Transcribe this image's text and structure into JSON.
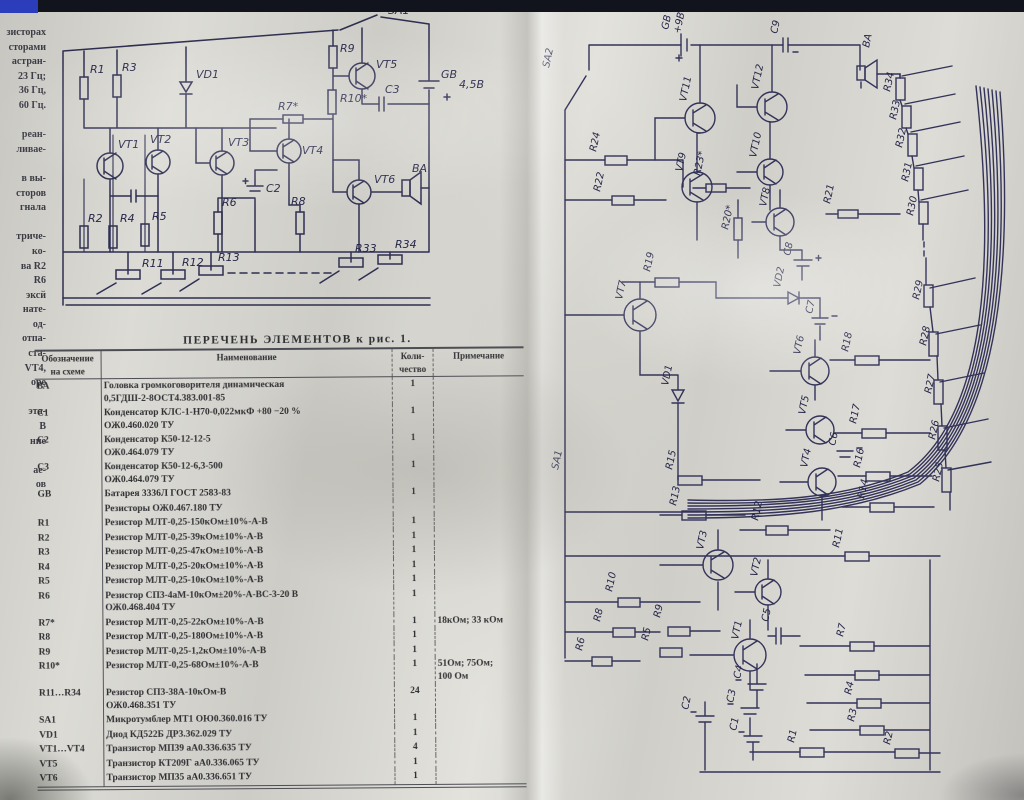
{
  "left_margin": {
    "lines": [
      "зисторах",
      "сторами",
      "астран-",
      "23 Гц;",
      "36 Гц,",
      "60 Гц.",
      "",
      "реан-",
      "ливае-",
      "",
      "в вы-",
      "сторов",
      "гнала",
      "",
      "триче-",
      "ко-",
      "ва R2",
      "R6",
      "эксй",
      "нате-",
      "од-",
      "отпа-",
      "ста-",
      "VT4,",
      "оре",
      "",
      "эта-",
      "В",
      "ние",
      "",
      "ае-",
      "ов"
    ]
  },
  "table": {
    "title": "ПЕРЕЧЕНЬ ЭЛЕМЕНТОВ к рис. 1.",
    "headers": {
      "designator": "Обозначение на схеме",
      "name": "Наименование",
      "qty": "Коли- чество",
      "note": "Примечание"
    },
    "rows": [
      {
        "d": "ВА",
        "n": [
          "Головка громкоговорителя динамическая",
          "0,5ГДШ-2-8ОСТ4.383.001-85"
        ],
        "q": "1",
        "note": []
      },
      {
        "d": "C1",
        "n": [
          "Конденсатор КЛС-1-Н70-0,022мкФ  +80 −20 %",
          "ОЖ0.460.020 ТУ"
        ],
        "q": "1",
        "note": []
      },
      {
        "d": "C2",
        "n": [
          "Конденсатор К50-12-12-5",
          "ОЖ0.464.079 ТУ"
        ],
        "q": "1",
        "note": []
      },
      {
        "d": "C3",
        "n": [
          "Конденсатор К50-12-6,3-500",
          "ОЖ0.464.079 ТУ"
        ],
        "q": "1",
        "note": []
      },
      {
        "d": "GB",
        "n": [
          "Батарея 3336Л ГОСТ 2583-83"
        ],
        "q": "1",
        "note": []
      },
      {
        "d": "",
        "n": [
          "Резисторы ОЖ0.467.180 ТУ"
        ],
        "q": "",
        "note": []
      },
      {
        "d": "R1",
        "n": [
          "Резистор МЛТ-0,25-150кОм±10%-А-В"
        ],
        "q": "1",
        "note": []
      },
      {
        "d": "R2",
        "n": [
          "Резистор МЛТ-0,25-39кОм±10%-А-В"
        ],
        "q": "1",
        "note": []
      },
      {
        "d": "R3",
        "n": [
          "Резистор МЛТ-0,25-47кОм±10%-А-В"
        ],
        "q": "1",
        "note": []
      },
      {
        "d": "R4",
        "n": [
          "Резистор МЛТ-0,25-20кОм±10%-А-В"
        ],
        "q": "1",
        "note": []
      },
      {
        "d": "R5",
        "n": [
          "Резистор МЛТ-0,25-10кОм±10%-А-В"
        ],
        "q": "1",
        "note": []
      },
      {
        "d": "R6",
        "n": [
          "Резистор СП3-4аМ-10кОм±20%-А-ВС-3-20 В",
          "ОЖ0.468.404 ТУ"
        ],
        "q": "1",
        "note": []
      },
      {
        "d": "R7*",
        "n": [
          "Резистор МЛТ-0,25-22кОм±10%-А-В"
        ],
        "q": "1",
        "note": [
          "18кОм; 33 кОм"
        ]
      },
      {
        "d": "R8",
        "n": [
          "Резистор МЛТ-0,25-180Ом±10%-А-В"
        ],
        "q": "1",
        "note": []
      },
      {
        "d": "R9",
        "n": [
          "Резистор МЛТ-0,25-1,2кОм±10%-А-В"
        ],
        "q": "1",
        "note": []
      },
      {
        "d": "R10*",
        "n": [
          "Резистор МЛТ-0,25-68Ом±10%-А-В"
        ],
        "q": "1",
        "note": [
          "51Ом; 75Ом;",
          "100 Ом"
        ]
      },
      {
        "d": "R11…R34",
        "n": [
          "Резистор СП3-38А-10кОм-В",
          "ОЖ0.468.351 ТУ"
        ],
        "q": "24",
        "note": []
      },
      {
        "d": "SA1",
        "n": [
          "Микротумблер МТ1 ОЮ0.360.016 ТУ"
        ],
        "q": "1",
        "note": []
      },
      {
        "d": "VD1",
        "n": [
          "Диод КД522Б ДР3.362.029 ТУ"
        ],
        "q": "1",
        "note": []
      },
      {
        "d": "VT1…VT4",
        "n": [
          "Транзистор МП39 аА0.336.635 ТУ"
        ],
        "q": "4",
        "note": []
      },
      {
        "d": "VT5",
        "n": [
          "Транзистор КТ209Г аА0.336.065 ТУ"
        ],
        "q": "1",
        "note": []
      },
      {
        "d": "VT6",
        "n": [
          "Транзистор МП35 аА0.336.651 ТУ"
        ],
        "q": "1",
        "note": []
      }
    ]
  },
  "fig1": {
    "labels": {
      "sa1": "SA1",
      "gb": "GB",
      "gb_v": "4,5В",
      "ba": "ВА",
      "vd1": "VD1",
      "vt1": "VT1",
      "vt2": "VT2",
      "vt3": "VT3",
      "vt4": "VT4",
      "vt5": "VT5",
      "vt6": "VT6",
      "r1": "R1",
      "r2": "R2",
      "r3": "R3",
      "r4": "R4",
      "r5": "R5",
      "r6": "R6",
      "r7": "R7*",
      "r8": "R8",
      "r9": "R9",
      "r10": "R10*",
      "r11": "R11",
      "r12": "R12",
      "r13": "R13",
      "r33": "R33",
      "r34": "R34",
      "c2": "C2",
      "c3": "C3"
    }
  },
  "fig2": {
    "labels": {
      "sa1": "SA1",
      "sa2": "SA2",
      "gb": "GB",
      "gb_v": "+9В",
      "c9": "C9",
      "ba": "ВА",
      "vt1": "VT1",
      "vt2": "VT2",
      "vt3": "VT3",
      "vt4": "VT4",
      "vt5": "VT5",
      "vt6": "VT6",
      "vt7": "VT7",
      "vt8": "VT8",
      "vt9": "VT9",
      "vt10": "VT10",
      "vt11": "VT11",
      "vt12": "VT12",
      "vd1": "VD1",
      "vd2": "VD2",
      "c1": "C1",
      "c2": "C2",
      "c3": "C3",
      "c4": "C4",
      "c5": "C5",
      "c6": "C6",
      "c7": "C7",
      "c8": "C8",
      "r1": "R1",
      "r2": "R2",
      "r3": "R3",
      "r4": "R4",
      "r5": "R5",
      "r6": "R6",
      "r7": "R7",
      "r8": "R8",
      "r9": "R9",
      "r10": "R10",
      "r11": "R11",
      "r12": "R12",
      "r13": "R13",
      "r14": "R14",
      "r15": "R15",
      "r16": "R16",
      "r17": "R17",
      "r18": "R18",
      "r19": "R19",
      "r20": "R20*",
      "r21": "R21",
      "r22": "R22",
      "r23": "R23*",
      "r24": "R24",
      "r25": "R25",
      "r26": "R26",
      "r27": "R27",
      "r28": "R28",
      "r29": "R29",
      "r30": "R30",
      "r31": "R31",
      "r32": "R32",
      "r33": "R33",
      "r34": "R34"
    }
  }
}
